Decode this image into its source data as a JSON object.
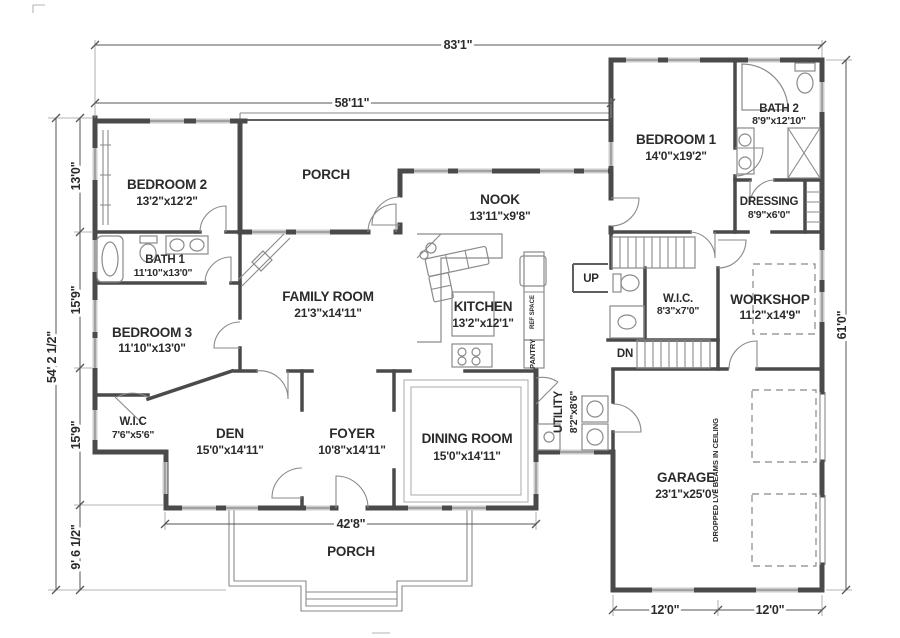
{
  "rooms": {
    "bedroom2": {
      "name": "BEDROOM 2",
      "size": "13'2\"x12'2\""
    },
    "porch_top": {
      "name": "PORCH"
    },
    "nook": {
      "name": "NOOK",
      "size": "13'11\"x9'8\""
    },
    "bedroom1": {
      "name": "BEDROOM 1",
      "size": "14'0\"x19'2\""
    },
    "bath2": {
      "name": "BATH 2",
      "size": "8'9\"x12'10\""
    },
    "dressing": {
      "name": "DRESSING",
      "size": "8'9\"x6'0\""
    },
    "bath1": {
      "name": "BATH 1",
      "size": "11'10\"x13'0\""
    },
    "family_room": {
      "name": "FAMILY ROOM",
      "size": "21'3\"x14'11\""
    },
    "kitchen": {
      "name": "KITCHEN",
      "size": "13'2\"x12'1\""
    },
    "wic_upper": {
      "name": "W.I.C.",
      "size": "8'3\"x7'0\""
    },
    "workshop": {
      "name": "WORKSHOP",
      "size": "11'2\"x14'9\""
    },
    "bedroom3": {
      "name": "BEDROOM 3",
      "size": "11'10\"x13'0\""
    },
    "wic_lower": {
      "name": "W.I.C",
      "size": "7'6\"x5'6\""
    },
    "den": {
      "name": "DEN",
      "size": "15'0\"x14'11\""
    },
    "foyer": {
      "name": "FOYER",
      "size": "10'8\"x14'11\""
    },
    "dining_room": {
      "name": "DINING ROOM",
      "size": "15'0\"x14'11\""
    },
    "utility": {
      "name": "UTILITY",
      "size": "8'2\"x8'6\""
    },
    "garage": {
      "name": "GARAGE",
      "size": "23'1\"x25'0\"",
      "note": "DROPPED LVL BEAMS IN CEILING"
    },
    "porch_bottom": {
      "name": "PORCH"
    }
  },
  "stairs": {
    "up": "UP",
    "down": "DN"
  },
  "kitchen_annotations": {
    "pantry": "PANTRY",
    "ref_space": "REF SPACE"
  },
  "dimensions": {
    "top_overall": "83'1\"",
    "top_left_section": "58'11\"",
    "left_overall": "54' 2 1/2\"",
    "left_top": "13'0\"",
    "left_mid_upper": "15'9\"",
    "left_mid_lower": "15'9\"",
    "left_bottom": "9' 6 1/2\"",
    "right_overall": "61'0\"",
    "bottom_main": "42'8\"",
    "garage_left": "12'0\"",
    "garage_right": "12'0\""
  },
  "colors": {
    "wall": "#4a4a4a",
    "window": "#cccccc",
    "dimension_line": "#555555",
    "text": "#2b2b2b"
  }
}
